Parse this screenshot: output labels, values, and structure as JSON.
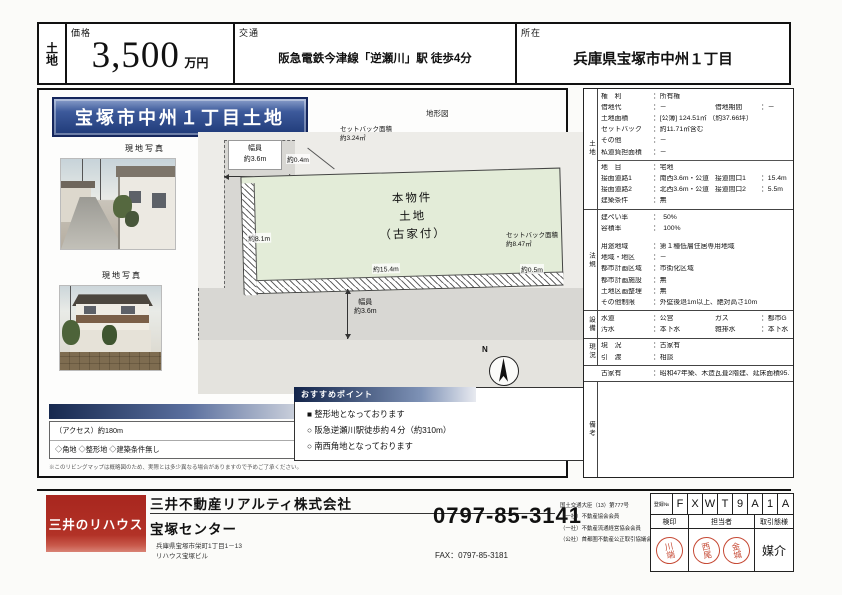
{
  "colors": {
    "banner_blue": "#1f3a78",
    "points_bar_blue": "#12244a",
    "logo_red": "#b23227",
    "stamp_red": "#c64a35",
    "plot_green": "#e3ecd8"
  },
  "header": {
    "type_label": "土地",
    "price_label": "価格",
    "price_value": "3,500",
    "price_unit": "万円",
    "transport_label": "交通",
    "transport_value": "阪急電鉄今津線「逆瀬川」駅 徒歩4分",
    "location_label": "所在",
    "location_value": "兵庫県宝塚市中州１丁目"
  },
  "main": {
    "title": "宝塚市中州１丁目土地",
    "photos": [
      {
        "caption": "現地写真"
      },
      {
        "caption": "現地写真"
      }
    ],
    "diagram": {
      "label": "地形図",
      "road_left": {
        "label": "幅員",
        "value": "約3.6m"
      },
      "setback_top": "約0.4m",
      "setback_area_top": {
        "label": "セットバック面積",
        "value": "約3.24㎡"
      },
      "side_length": "約8.1m",
      "parcel": [
        "本物件",
        "土地",
        "（古家付）"
      ],
      "bottom_length": "約15.4m",
      "setback_area_right": {
        "label": "セットバック面積",
        "value": "約8.47㎡"
      },
      "setback_bottom": "約0.5m",
      "road_bottom": {
        "label": "幅員",
        "value": "約3.6m"
      },
      "compass_n": "N"
    },
    "access": {
      "line1": "（アクセス）約180m",
      "line2": "◇角地 ◇整形地 ◇建築条件無し",
      "disclaimer": "※このリビングマップは概略図のため、実際とは多少異なる場合がありますので予めご了承ください。"
    },
    "points": {
      "header": "おすすめポイント",
      "items": [
        "■ 整形地となっております",
        "○ 阪急逆瀬川駅徒歩約４分（約310m）",
        "○ 南西角地となっております"
      ]
    }
  },
  "details": {
    "groups": [
      {
        "label": "土地",
        "rows": [
          {
            "c": [
              [
                "権　利",
                "：所有権"
              ]
            ]
          },
          {
            "c": [
              [
                "借地代",
                "：－"
              ],
              [
                "借地期間",
                "：－"
              ]
            ]
          },
          {
            "c": [
              [
                "土地面積",
                "：[公簿] 124.51㎡ （約37.66坪）"
              ]
            ]
          },
          {
            "c": [
              [
                "セットバック",
                "：約11.71㎡含む"
              ]
            ]
          },
          {
            "c": [
              [
                "その他",
                "：－"
              ]
            ]
          },
          {
            "c": [
              [
                "私道負担面積",
                "：－"
              ]
            ]
          },
          {
            "hr": true
          },
          {
            "c": [
              [
                "地　目",
                "：宅地"
              ]
            ]
          },
          {
            "c": [
              [
                "接面道路1",
                "：南西3.6m・公道"
              ],
              [
                "接道間口1",
                "：15.4m"
              ]
            ]
          },
          {
            "c": [
              [
                "接面道路2",
                "：北西3.6m・公道"
              ],
              [
                "接道間口2",
                "：5.5m"
              ]
            ]
          },
          {
            "c": [
              [
                "建築条件",
                "：無"
              ]
            ]
          }
        ]
      },
      {
        "label": "法規",
        "rows": [
          {
            "c": [
              [
                "建ぺい率",
                "：　50%"
              ]
            ]
          },
          {
            "c": [
              [
                "容積率",
                "：　100%"
              ]
            ]
          },
          {
            "gap": true
          },
          {
            "c": [
              [
                "用途地域",
                "：第１種低層住居専用地域"
              ]
            ]
          },
          {
            "c": [
              [
                "地域・地区",
                "：－"
              ]
            ]
          },
          {
            "c": [
              [
                "都市計画区域",
                "：市街化区域"
              ]
            ]
          },
          {
            "c": [
              [
                "都市計画施設",
                "：無"
              ]
            ]
          },
          {
            "c": [
              [
                "土地区画整理",
                "：無"
              ]
            ]
          },
          {
            "c": [
              [
                "その他制限",
                "：外壁後退1m以上、絶対高さ10m"
              ]
            ]
          }
        ]
      },
      {
        "label": "設備",
        "rows": [
          {
            "c": [
              [
                "水道",
                "：公営"
              ],
              [
                "ガス",
                "：都市G"
              ]
            ]
          },
          {
            "c": [
              [
                "汚水",
                "：本下水"
              ],
              [
                "雑排水",
                "：本下水"
              ]
            ]
          }
        ]
      },
      {
        "label": "現況",
        "rows": [
          {
            "c": [
              [
                "現　況",
                "：古家有"
              ]
            ]
          },
          {
            "c": [
              [
                "引　渡",
                "：相談"
              ]
            ]
          }
        ]
      },
      {
        "label": "",
        "note": true,
        "rows": [
          {
            "c": [
              [
                "古家有",
                "：昭和47年築、木造瓦葺2階建、延床面積95.74㎡"
              ]
            ]
          }
        ]
      },
      {
        "label": "備考",
        "fill": true,
        "rows": []
      }
    ]
  },
  "footer": {
    "logo": "三井のリハウス",
    "company": "三井不動産リアルティ株式会社",
    "branch": "宝塚センター",
    "address1": "兵庫県宝塚市栄町1丁目1－13",
    "address2": "リハウス宝塚ビル",
    "phone": "0797-85-3141",
    "fax": "FAX：0797-85-3181",
    "licenses": [
      "国土交通大臣（13）第777号",
      "（一社）不動産協会会員",
      "（一社）不動産流通経営協会会員",
      "（公社）首都圏不動産公正取引協議会加盟"
    ],
    "reg_label": "登録№",
    "reg_code": [
      "F",
      "X",
      "W",
      "T",
      "9",
      "A",
      "1",
      "A"
    ],
    "stamp_headers": [
      "検印",
      "担当者",
      "取引態様"
    ],
    "stamps": [
      "川端",
      "西尾",
      "金城"
    ],
    "transaction_type": "媒介"
  }
}
